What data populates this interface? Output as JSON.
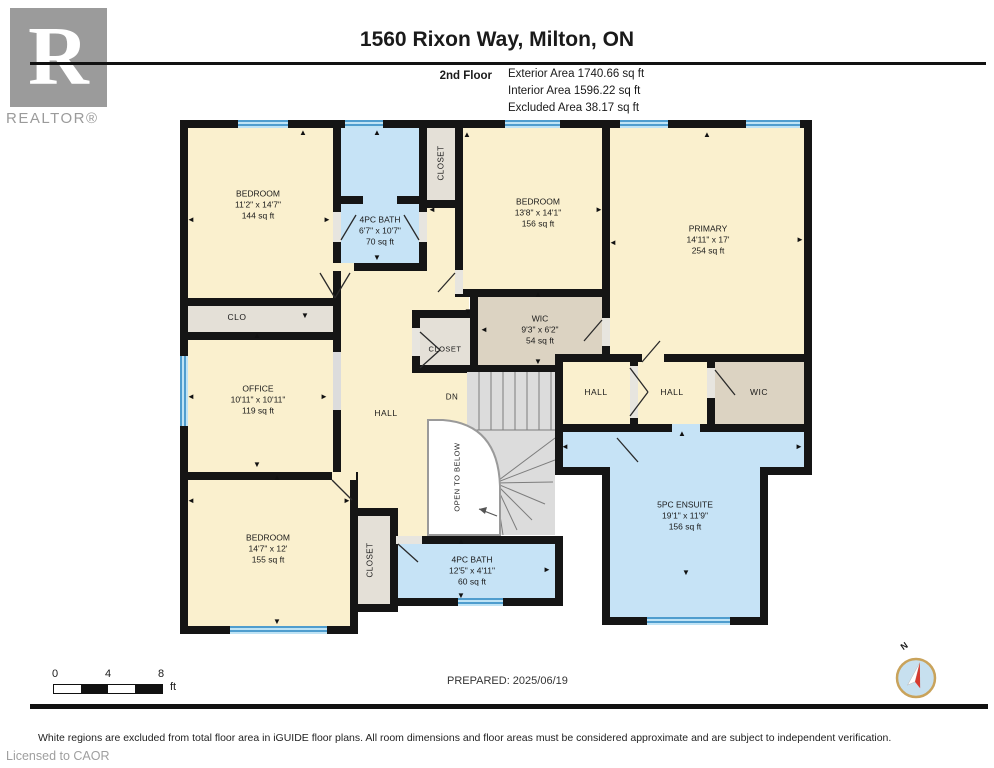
{
  "header": {
    "logo_letter": "R",
    "logo_text": "REALTOR®",
    "title": "1560 Rixon Way, Milton, ON",
    "floor_label": "2nd Floor",
    "exterior": "Exterior Area 1740.66 sq ft",
    "interior": "Interior Area 1596.22 sq ft",
    "excluded": "Excluded Area 38.17 sq ft"
  },
  "rooms": [
    {
      "name": "BEDROOM",
      "dims": "11'2\" x 14'7\"",
      "area": "144 sq ft"
    },
    {
      "name": "4PC BATH",
      "dims": "6'7\" x 10'7\"",
      "area": "70 sq ft"
    },
    {
      "name": "BEDROOM",
      "dims": "13'8\" x 14'1\"",
      "area": "156 sq ft"
    },
    {
      "name": "PRIMARY",
      "dims": "14'11\" x 17'",
      "area": "254 sq ft"
    },
    {
      "name": "WIC",
      "dims": "9'3\" x 6'2\"",
      "area": "54 sq ft"
    },
    {
      "name": "OFFICE",
      "dims": "10'11\" x 10'11\"",
      "area": "119 sq ft"
    },
    {
      "name": "5PC ENSUITE",
      "dims": "19'1\" x 11'9\"",
      "area": "156 sq ft"
    },
    {
      "name": "BEDROOM",
      "dims": "14'7\" x 12'",
      "area": "155 sq ft"
    },
    {
      "name": "4PC BATH",
      "dims": "12'5\" x 4'11\"",
      "area": "60 sq ft"
    }
  ],
  "labels": {
    "clo": "CLO",
    "closet": "CLOSET",
    "hall": "HALL",
    "dn": "DN",
    "open_to_below": "OPEN TO BELOW",
    "wic": "WIC"
  },
  "icons": {
    "up": "▲",
    "down": "▼",
    "left": "◄",
    "right": "►"
  },
  "footer": {
    "scale_ticks": [
      "0",
      "4",
      "8"
    ],
    "scale_unit": "ft",
    "prepared": "PREPARED: 2025/06/19",
    "compass_north": "N",
    "disclaimer": "White regions are excluded from total floor area in iGUIDE floor plans. All room dimensions and floor areas must be considered approximate and are subject to independent verification.",
    "license": "Licensed to CAOR"
  }
}
